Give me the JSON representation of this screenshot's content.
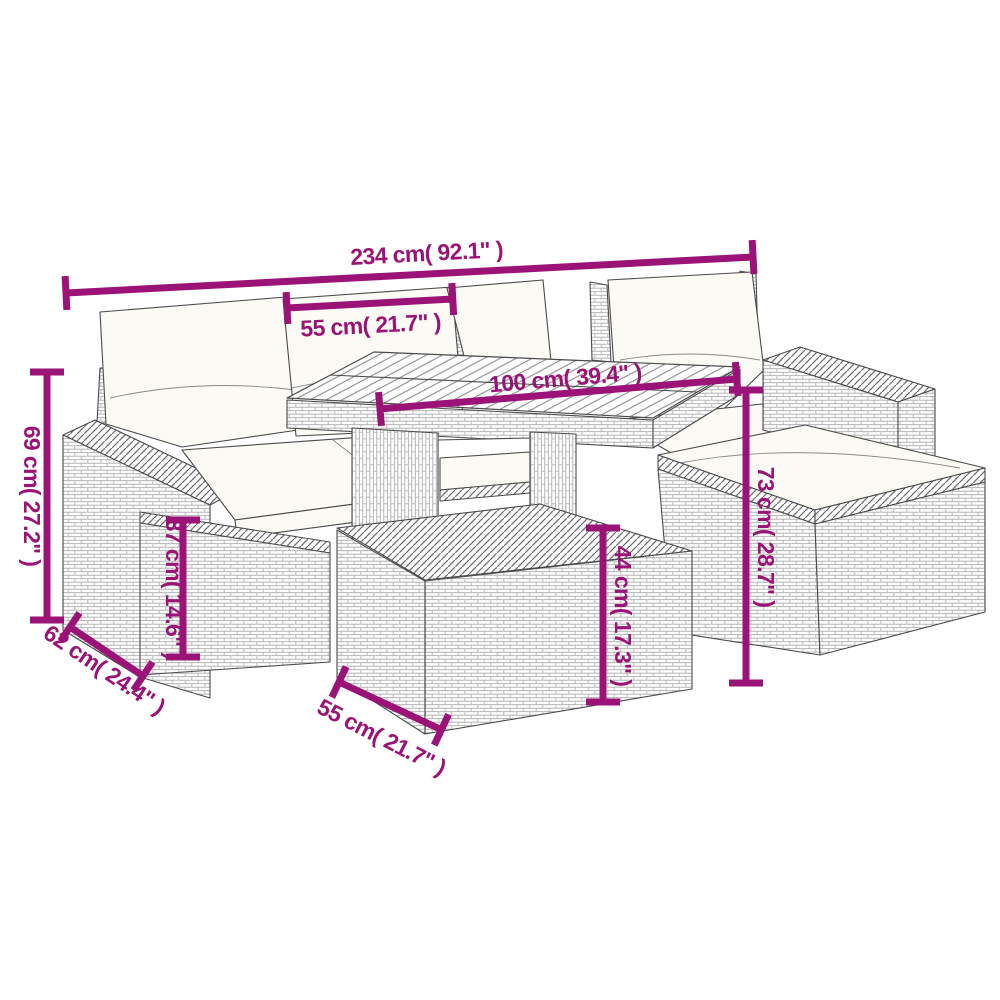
{
  "colors": {
    "accent": "#9B1377",
    "line": "#4a4a4a",
    "wicker": "#a8a8a8",
    "cushion": "#fbfaf4",
    "background": "#ffffff"
  },
  "dimensions": {
    "overall_width": {
      "label": "234 cm( 92.1\" )"
    },
    "cushion_width": {
      "label": "55 cm( 21.7\" )"
    },
    "table_width": {
      "label": "100 cm( 39.4\" )"
    },
    "overall_height": {
      "label": "69 cm( 27.2\" )"
    },
    "seat_height": {
      "label": "37 cm( 14.6\" )"
    },
    "seat_depth": {
      "label": "62 cm( 24.4\" )"
    },
    "back_height": {
      "label": "73 cm( 28.7\" )"
    },
    "table_height": {
      "label": "44 cm( 17.3\" )"
    },
    "table_depth": {
      "label": "55 cm( 21.7\" )"
    }
  }
}
